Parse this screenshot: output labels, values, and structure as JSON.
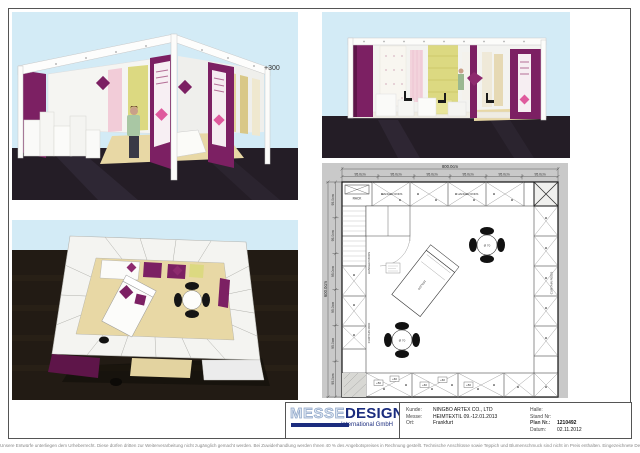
{
  "colors": {
    "purple": "#7C2063",
    "purple_dark": "#5E1549",
    "sky": "#D3EBF6",
    "floor_dark": "#241D26",
    "floor_brown": "#221B14",
    "beige": "#E8D8A5",
    "fabric_yellow": "#DCD981",
    "fabric_pink": "#F2CCD8",
    "logo_navy": "#1B2C7E",
    "plan_gray": "#C9C9C9"
  },
  "renders": {
    "perspective": {
      "elevation_label": "+300"
    }
  },
  "plan": {
    "overall_width": "800.0cm",
    "overall_depth": "600.0cm",
    "panel_width": "95.0cm",
    "panel_depth": "95.0cm",
    "labels": {
      "rack": "RACK",
      "hanger_rods": "HANGER RODS",
      "curtain_rods": "CURTAIN RODS",
      "curtain_rod": "CURTAIN ROD",
      "table_diameter": "Ø 70",
      "bed_size": "180x200",
      "plus50": "+50",
      "plus60": "+60"
    }
  },
  "titleblock": {
    "logo": {
      "word1": "MESSE",
      "word2": "DESIGN",
      "subtitle": "International GmbH"
    },
    "fields_left": [
      {
        "label": "Kunde:",
        "value": "NINGBO ARTEX CO., LTD"
      },
      {
        "label": "Messe:",
        "value": "HEIMTEXTIL 09.-12.01.2013"
      },
      {
        "label": "Ort:",
        "value": "Frankfurt"
      }
    ],
    "fields_right": [
      {
        "label": "Halle:",
        "value": ""
      },
      {
        "label": "Stand Nr:",
        "value": ""
      },
      {
        "label": "Plan Nr.:",
        "value": "1210492"
      },
      {
        "label": "Datum:",
        "value": "02.11.2012"
      }
    ]
  },
  "footer": {
    "disclaimer": "Unsere Entwürfe unterliegen dem Urheberrecht. Diese dürfen dritten zur Weiterverarbeitung nicht zugänglich gemacht werden. Bei Zuwiderhandlung werden Ihnen 40 % des Angebotspreises in Rechnung gestellt. Technische Anschlüsse sowie Teppich und Blumenschmuck sind nicht im Preis enthalten. Eingezeichnete Dekorationen und Gegenstände, die nicht in der Leistungsbeschreibung enthalten sind, gehören nicht zum Lieferumfang. Änderungen durch die Messe bleiben vorbehalten."
  }
}
